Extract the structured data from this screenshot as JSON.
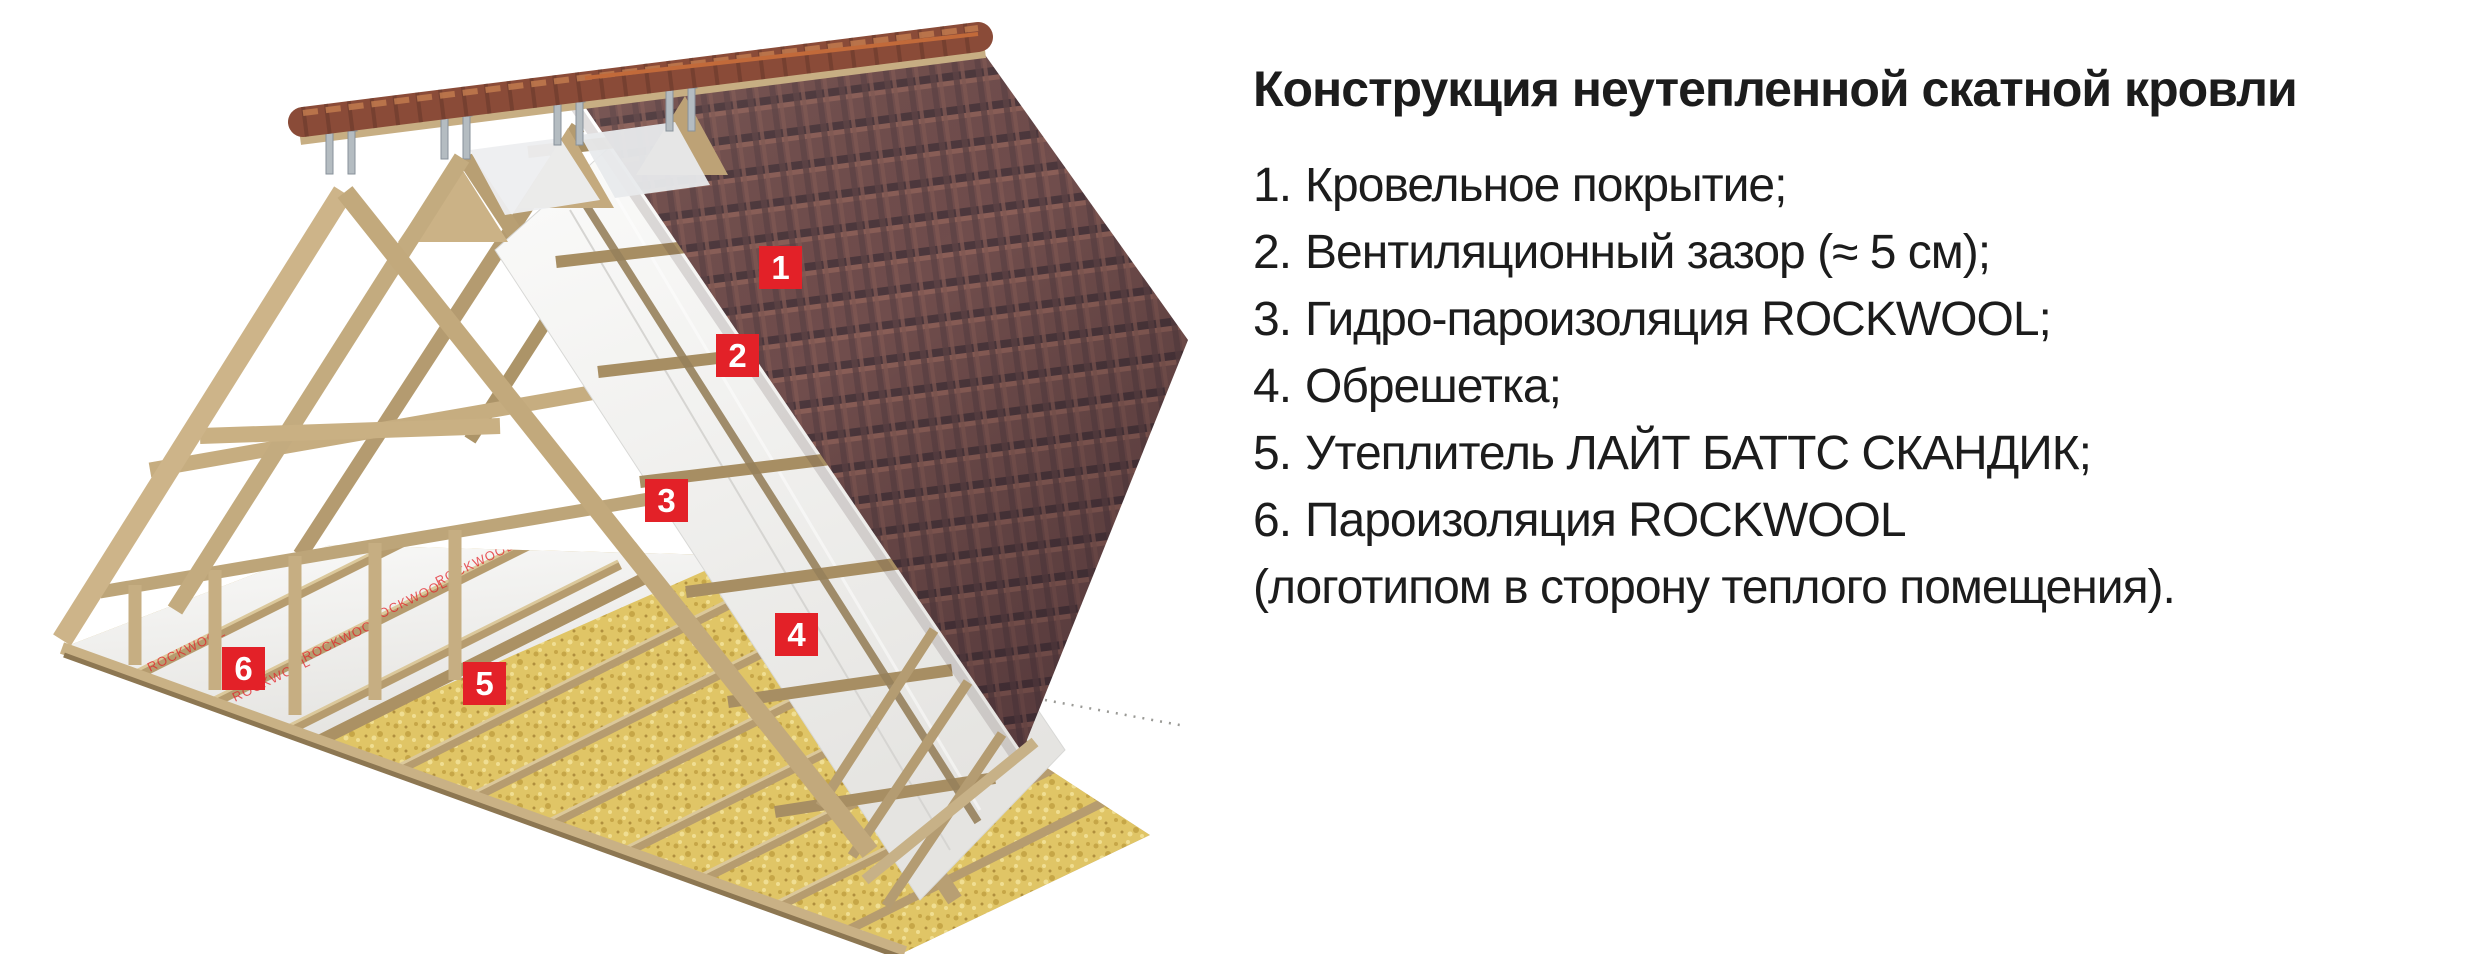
{
  "illustration": {
    "membrane_print": "ROCKWOOL",
    "markers": [
      {
        "num": "1"
      },
      {
        "num": "2"
      },
      {
        "num": "3"
      },
      {
        "num": "4"
      },
      {
        "num": "5"
      },
      {
        "num": "6"
      }
    ]
  },
  "legend": {
    "title": "Конструкция неутепленной скатной кровли",
    "items": [
      {
        "num": "1.",
        "text": "Кровельное покрытие;"
      },
      {
        "num": "2.",
        "text": "Вентиляционный зазор (≈ 5 см);"
      },
      {
        "num": "3.",
        "text": "Гидро-пароизоляция ROCKWOOL;"
      },
      {
        "num": "4.",
        "text": "Обрешетка;"
      },
      {
        "num": "5.",
        "text": "Утеплитель ЛАЙТ БАТТС СКАНДИК;"
      },
      {
        "num": "6.",
        "text": "Пароизоляция ROCKWOOL"
      }
    ],
    "footnote": "(логотипом в сторону теплого помещения)."
  },
  "colors": {
    "marker_red": "#e32128",
    "text": "#1c1c1c",
    "tile": "#704d4c",
    "tile_dark": "#4c373c",
    "tile_light": "#8a5e57",
    "ridge": "#8a4b38",
    "ridge_dark": "#5d3427",
    "ridge_light": "#c17a4e",
    "wood": "#cdb489",
    "wood_mid": "#b69c6f",
    "wood_dark": "#8d7752",
    "insulation": "#e0c566",
    "membrane": "#f4f3f1",
    "metal": "#b4bcc1"
  }
}
